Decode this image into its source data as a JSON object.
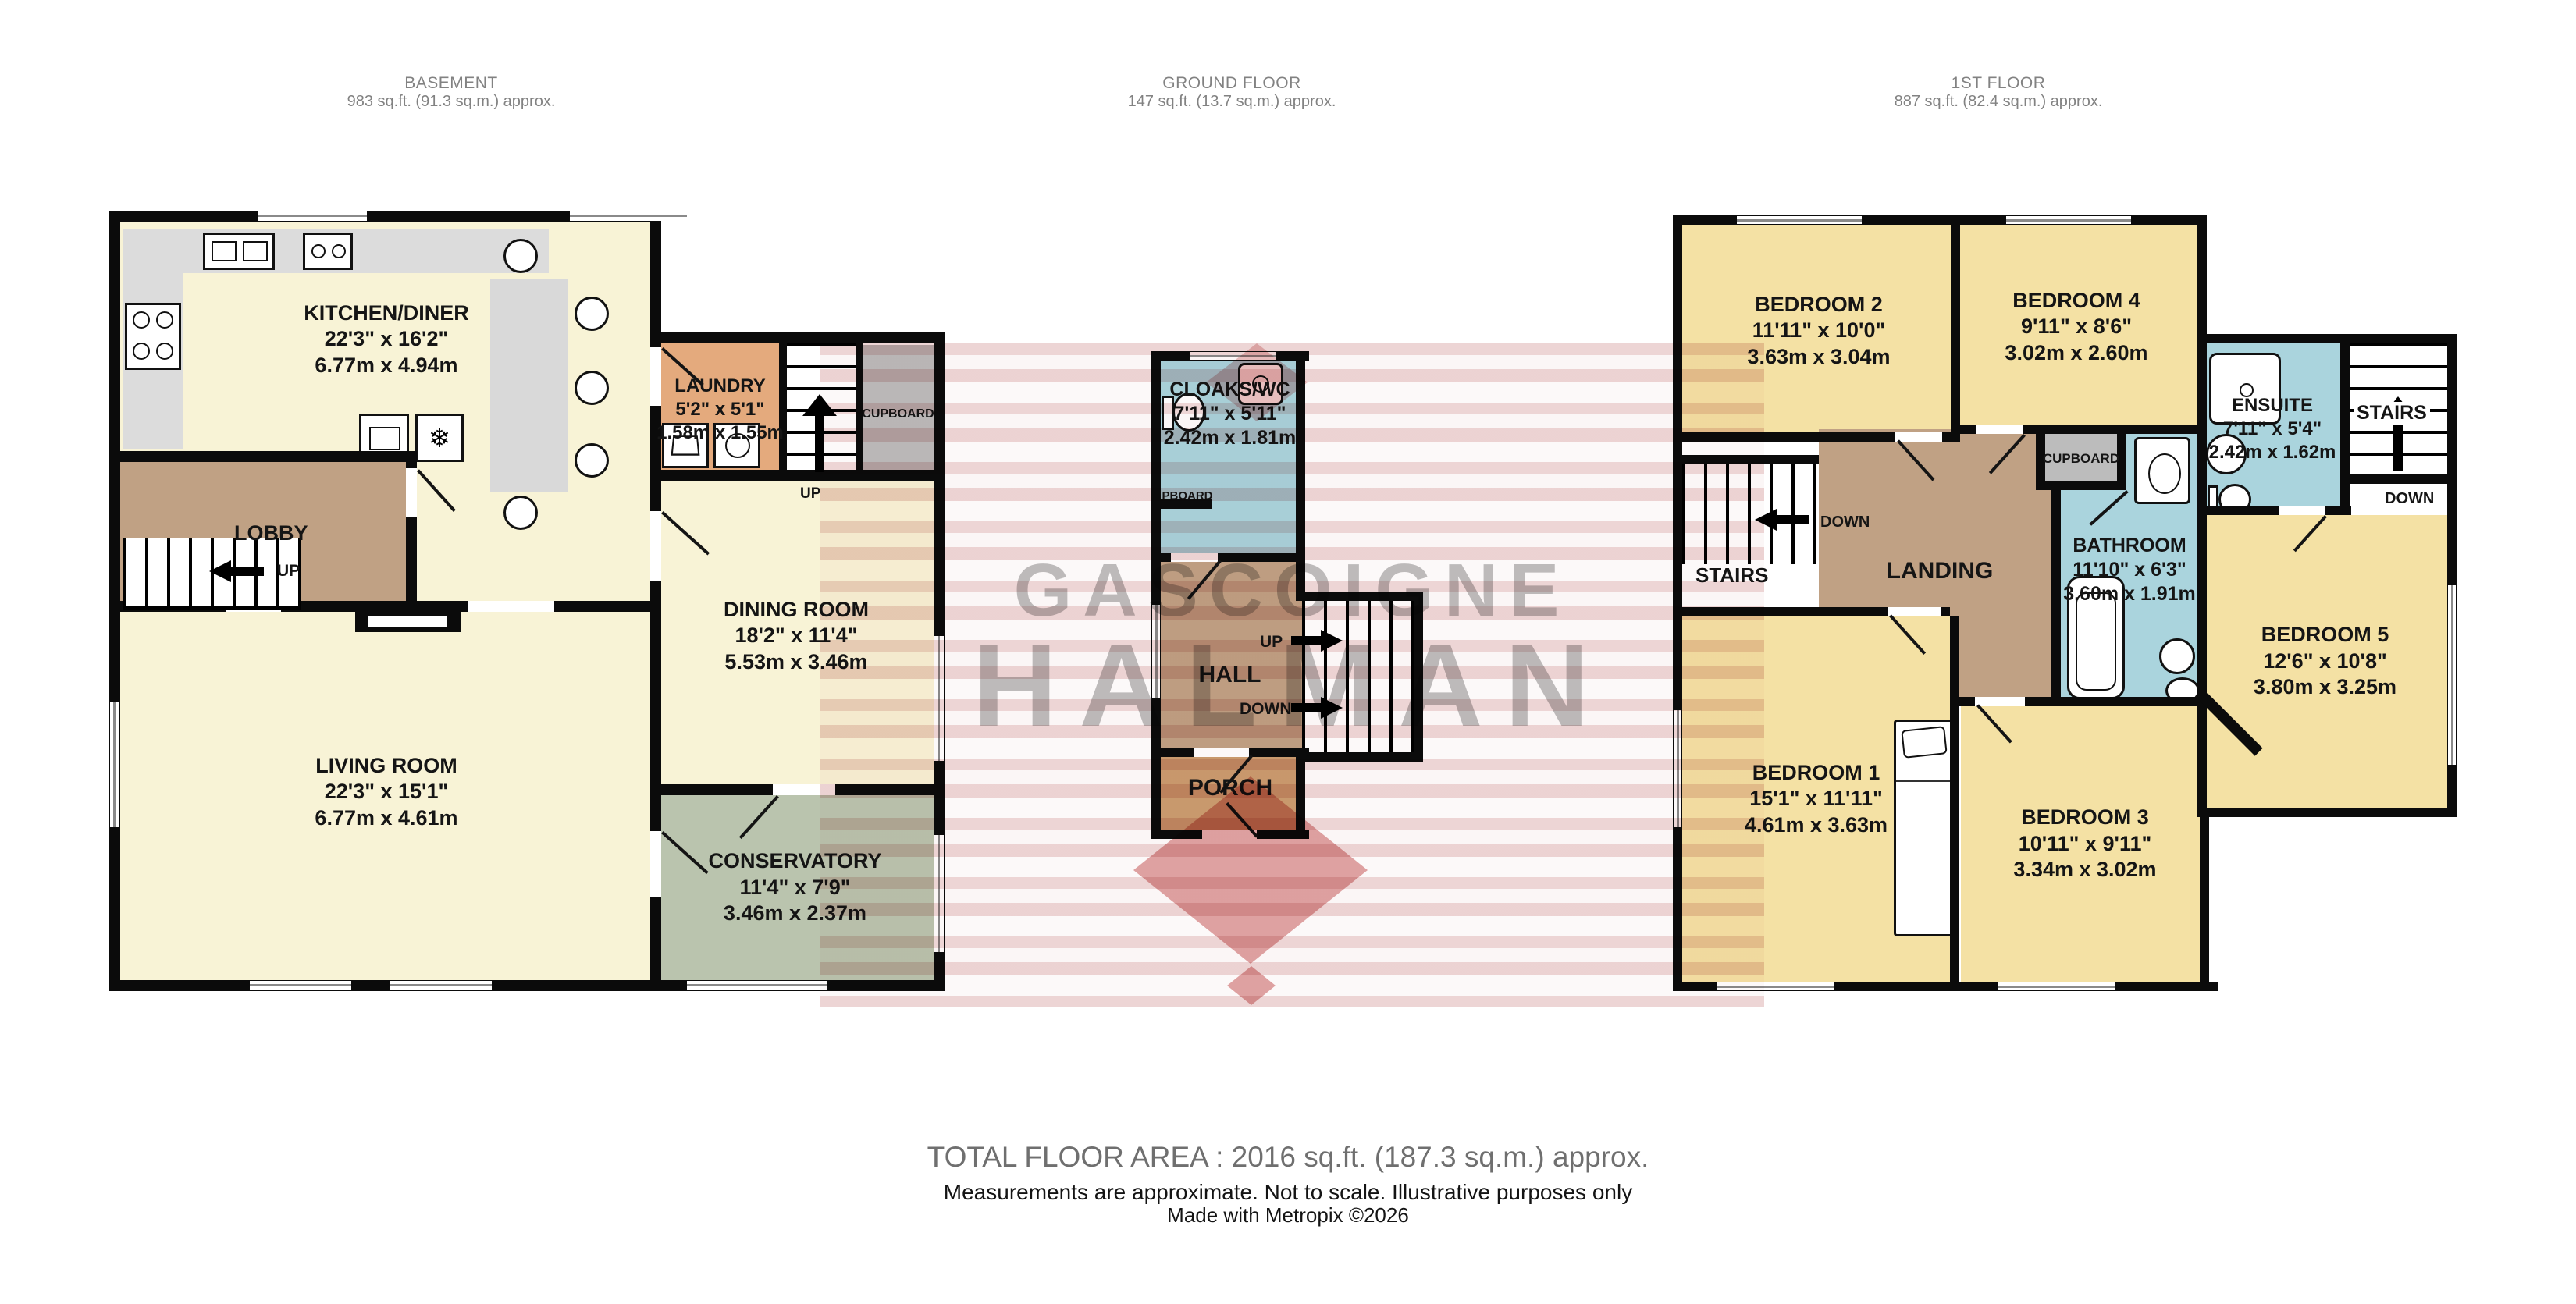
{
  "floors": {
    "basement": {
      "title": "BASEMENT",
      "area": "983 sq.ft. (91.3 sq.m.) approx."
    },
    "ground": {
      "title": "GROUND FLOOR",
      "area": "147 sq.ft. (13.7 sq.m.) approx."
    },
    "first": {
      "title": "1ST FLOOR",
      "area": "887 sq.ft. (82.4 sq.m.) approx."
    }
  },
  "rooms": {
    "kitchen": {
      "name": "KITCHEN/DINER",
      "imperial": "22'3\"  x 16'2\"",
      "metric": "6.77m  x 4.94m"
    },
    "laundry": {
      "name": "LAUNDRY",
      "imperial": "5'2\"  x 5'1\"",
      "metric": "1.58m  x 1.55m"
    },
    "cupboard_basement": {
      "name": "CUPBOARD"
    },
    "lobby": {
      "name": "LOBBY"
    },
    "dining": {
      "name": "DINING ROOM",
      "imperial": "18'2\"  x 11'4\"",
      "metric": "5.53m  x 3.46m"
    },
    "living": {
      "name": "LIVING ROOM",
      "imperial": "22'3\"  x 15'1\"",
      "metric": "6.77m  x 4.61m"
    },
    "conservatory": {
      "name": "CONSERVATORY",
      "imperial": "11'4\"  x 7'9\"",
      "metric": "3.46m  x 2.37m"
    },
    "cloaks": {
      "name": "CLOAKS/WC",
      "imperial": "7'11\"  x 5'11\"",
      "metric": "2.42m  x 1.81m"
    },
    "pboard": {
      "name": "PBOARD"
    },
    "hall": {
      "name": "HALL"
    },
    "porch": {
      "name": "PORCH"
    },
    "bedroom1": {
      "name": "BEDROOM 1",
      "imperial": "15'1\"  x 11'11\"",
      "metric": "4.61m  x 3.63m"
    },
    "bedroom2": {
      "name": "BEDROOM 2",
      "imperial": "11'11\"  x 10'0\"",
      "metric": "3.63m  x 3.04m"
    },
    "bedroom3": {
      "name": "BEDROOM 3",
      "imperial": "10'11\"  x 9'11\"",
      "metric": "3.34m  x 3.02m"
    },
    "bedroom4": {
      "name": "BEDROOM 4",
      "imperial": "9'11\"  x 8'6\"",
      "metric": "3.02m  x 2.60m"
    },
    "bedroom5": {
      "name": "BEDROOM 5",
      "imperial": "12'6\"  x 10'8\"",
      "metric": "3.80m  x 3.25m"
    },
    "bathroom": {
      "name": "BATHROOM",
      "imperial": "11'10\"  x 6'3\"",
      "metric": "3.60m  x 1.91m"
    },
    "ensuite": {
      "name": "ENSUITE",
      "imperial": "7'11\"  x 5'4\"",
      "metric": "2.42m  x 1.62m"
    },
    "landing": {
      "name": "LANDING"
    },
    "stairs_first_left": {
      "name": "STAIRS"
    },
    "stairs_first_right": {
      "name": "STAIRS"
    },
    "cupboard_first": {
      "name": "CUPBOARD"
    }
  },
  "directions": {
    "up": "UP",
    "down": "DOWN"
  },
  "watermark": {
    "line1": "GASCOIGNE",
    "line2": "HALMAN"
  },
  "footer": {
    "total": "TOTAL FLOOR AREA : 2016 sq.ft. (187.3 sq.m.) approx.",
    "disclaimer": "Measurements are approximate.  Not to scale.  Illustrative purposes only",
    "credit": "Made with Metropix ©2026"
  },
  "colors": {
    "cream": "#f8f3d6",
    "bedroom_yellow": "#f4e1a4",
    "hallway_brown": "#c0a184",
    "porch_tan": "#cb9d70",
    "laundry_orange": "#e4aa7d",
    "wet_blue": "#aad4dd",
    "conservatory_green": "#bac4ae",
    "cupboard_gray": "#bcbcbc",
    "counter_gray": "#dcdcdc",
    "wall_black": "#0b0b0b",
    "watermark_red": "#c65252"
  }
}
